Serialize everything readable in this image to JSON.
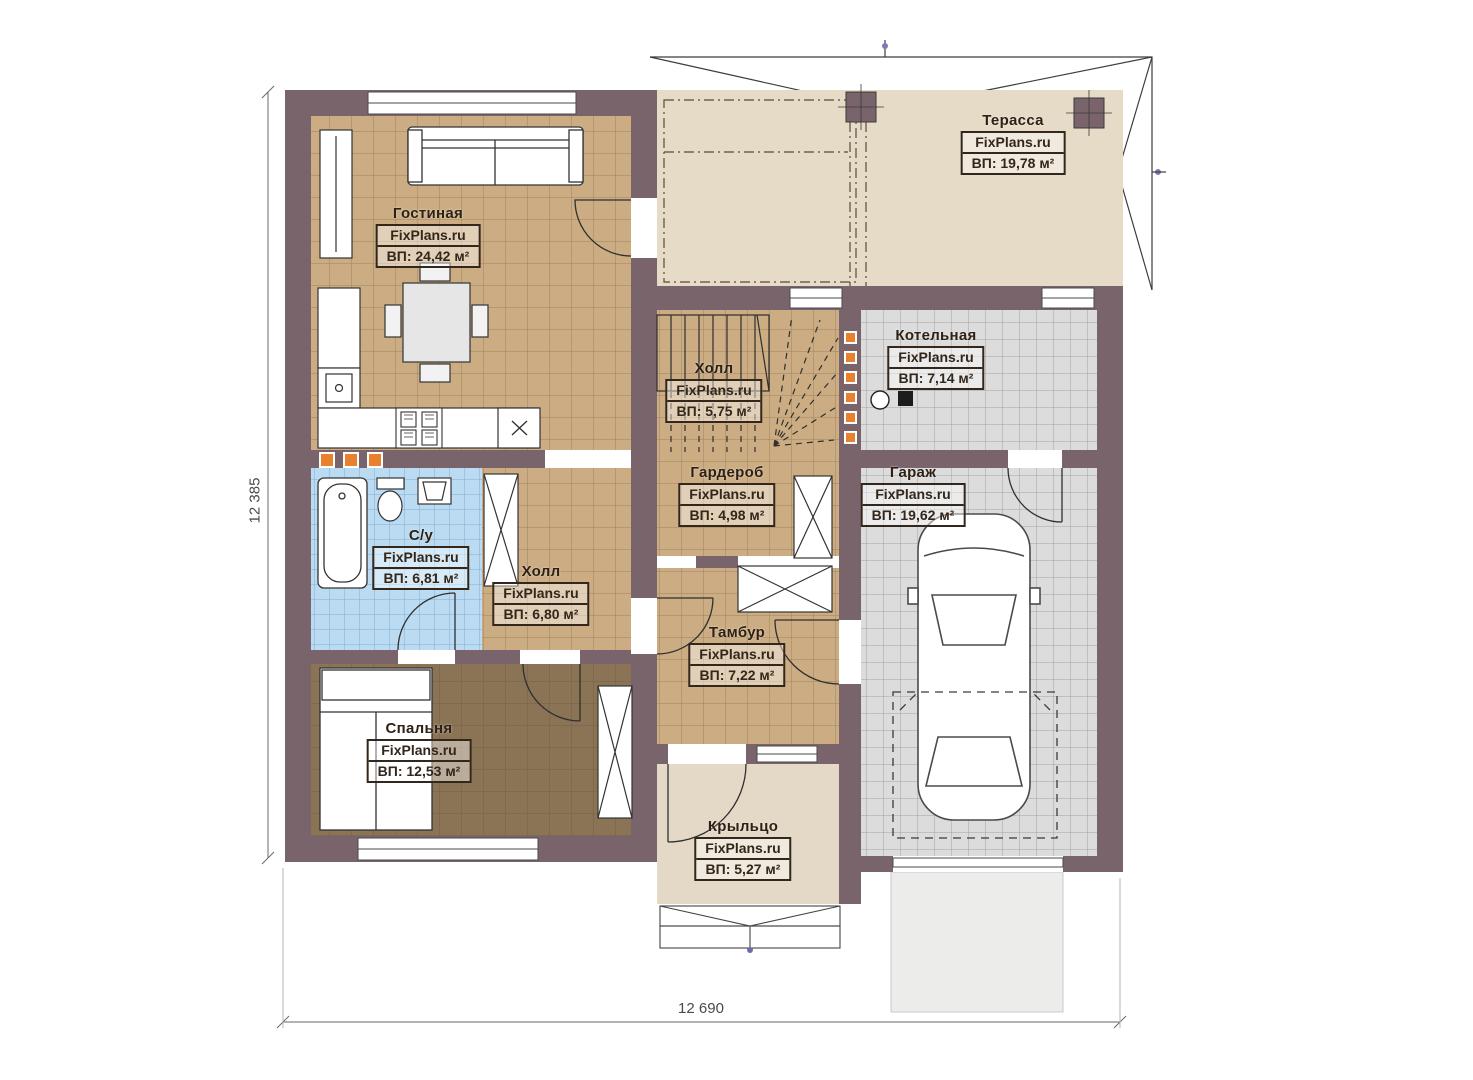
{
  "plan_title": "FixPlans.ru floor plan",
  "watermark": "FixPlans.ru",
  "rooms": [
    {
      "name": "Гостиная",
      "watermark": "FixPlans.ru",
      "area": "ВП: 24,42 м²"
    },
    {
      "name": "Терасса",
      "watermark": "FixPlans.ru",
      "area": "ВП: 19,78 м²"
    },
    {
      "name": "Котельная",
      "watermark": "FixPlans.ru",
      "area": "ВП: 7,14 м²"
    },
    {
      "name": "Холл",
      "watermark": "FixPlans.ru",
      "area": "ВП: 5,75 м²"
    },
    {
      "name": "Гардероб",
      "watermark": "FixPlans.ru",
      "area": "ВП: 4,98 м²"
    },
    {
      "name": "Гараж",
      "watermark": "FixPlans.ru",
      "area": "ВП: 19,62 м²"
    },
    {
      "name": "С/у",
      "watermark": "FixPlans.ru",
      "area": "ВП: 6,81 м²"
    },
    {
      "name": "Холл",
      "watermark": "FixPlans.ru",
      "area": "ВП: 6,80 м²"
    },
    {
      "name": "Тамбур",
      "watermark": "FixPlans.ru",
      "area": "ВП: 7,22 м²"
    },
    {
      "name": "Спальня",
      "watermark": "FixPlans.ru",
      "area": "ВП: 12,53 м²"
    },
    {
      "name": "Крыльцо",
      "watermark": "FixPlans.ru",
      "area": "ВП: 5,27 м²"
    }
  ],
  "dimensions": {
    "left": "12 385",
    "bottom": "12 690"
  },
  "colors": {
    "wall": "#7a646c",
    "floor_tan": "#cbac83",
    "floor_beige": "#e6dbc7",
    "floor_gray": "#dcdcdc",
    "floor_blue": "#b9d8f0",
    "floor_brown": "#8b7355",
    "accent_orange": "#e8802e"
  }
}
